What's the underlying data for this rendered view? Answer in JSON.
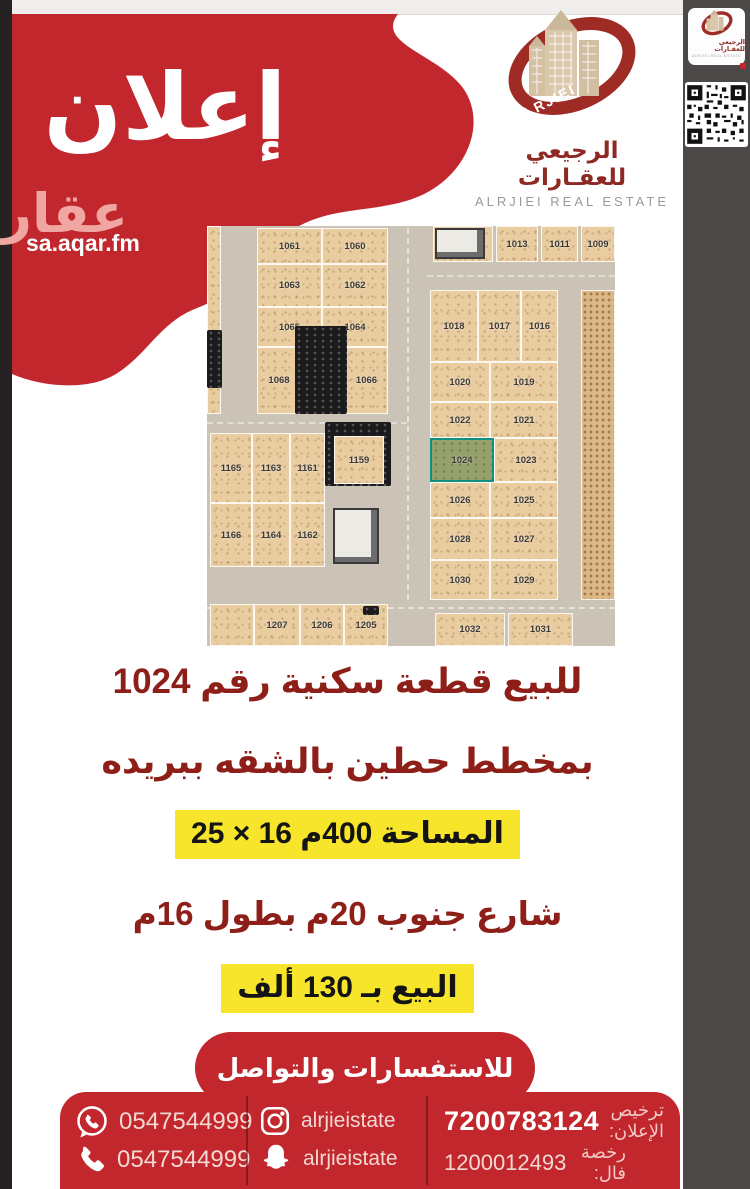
{
  "brand": {
    "announcement": "إعلان",
    "aqar_word": "عقار",
    "aqar_url": "sa.aqar.fm",
    "logo_name_ar": "الرجيعي للعقـارات",
    "logo_name_en": "ALRJIEI REAL ESTATE",
    "logo_ribbon": "ALRJIEI"
  },
  "sidebar": {
    "items": [
      {
        "icon": "location-pin",
        "label": "بريدة - حي الشقة"
      },
      {
        "icon": "land-plot",
        "label": "أرض للبيع"
      },
      {
        "icon": "area-resize",
        "label": "400 م²"
      },
      {
        "icon": "price-money",
        "label": "130 ألف"
      }
    ]
  },
  "details": {
    "line1": "للبيع قطعة سكنية رقم 1024",
    "line2": "بمخطط حطين بالشقه ببريده",
    "line3": "المساحة 400م 16 × 25",
    "line4": "شارع جنوب 20م بطول 16م",
    "line5": "البيع بـ 130 ألف"
  },
  "contact": {
    "heading": "للاستفسارات والتواصل",
    "whatsapp": "0547544999",
    "phone": "0547544999",
    "instagram": "alrjieistate",
    "snapchat": "alrjieistate",
    "ad_license_label": "ترخيص الإعلان:",
    "ad_license": "7200783124",
    "fal_license_label": "رخصة فال:",
    "fal_license": "1200012493"
  },
  "colors": {
    "red": "#c1272d",
    "maroon_text": "#8e1e18",
    "yellow_highlight": "#f6e52b",
    "sidebar_bg": "#4b4847",
    "green_accent": "#55b157",
    "highlight_plot_border": "#0f9080"
  },
  "map": {
    "highlighted_plot": "1024",
    "plots": [
      {
        "label": "",
        "x": 0,
        "y": 0,
        "w": 14,
        "h": 188
      },
      {
        "label": "1061",
        "x": 50,
        "y": 2,
        "w": 65,
        "h": 36
      },
      {
        "label": "1060",
        "x": 115,
        "y": 2,
        "w": 66,
        "h": 36
      },
      {
        "label": "1063",
        "x": 50,
        "y": 38,
        "w": 65,
        "h": 43
      },
      {
        "label": "1062",
        "x": 115,
        "y": 38,
        "w": 66,
        "h": 43
      },
      {
        "label": "1065",
        "x": 50,
        "y": 81,
        "w": 65,
        "h": 40
      },
      {
        "label": "1064",
        "x": 115,
        "y": 81,
        "w": 66,
        "h": 40
      },
      {
        "label": "1068",
        "x": 50,
        "y": 121,
        "w": 44,
        "h": 67
      },
      {
        "label": "",
        "x": 94,
        "y": 121,
        "w": 44,
        "h": 67
      },
      {
        "label": "1066",
        "x": 138,
        "y": 121,
        "w": 43,
        "h": 67
      },
      {
        "label": "1015",
        "x": 226,
        "y": 0,
        "w": 60,
        "h": 36
      },
      {
        "label": "1013",
        "x": 289,
        "y": 0,
        "w": 42,
        "h": 36
      },
      {
        "label": "1011",
        "x": 334,
        "y": 0,
        "w": 37,
        "h": 36
      },
      {
        "label": "1009",
        "x": 374,
        "y": 0,
        "w": 34,
        "h": 36
      },
      {
        "label": "1018",
        "x": 223,
        "y": 64,
        "w": 48,
        "h": 72
      },
      {
        "label": "1017",
        "x": 271,
        "y": 64,
        "w": 43,
        "h": 72
      },
      {
        "label": "1016",
        "x": 314,
        "y": 64,
        "w": 37,
        "h": 72
      },
      {
        "label": "1020",
        "x": 223,
        "y": 136,
        "w": 60,
        "h": 40
      },
      {
        "label": "1019",
        "x": 283,
        "y": 136,
        "w": 68,
        "h": 40
      },
      {
        "label": "1022",
        "x": 223,
        "y": 176,
        "w": 60,
        "h": 36
      },
      {
        "label": "1021",
        "x": 283,
        "y": 176,
        "w": 68,
        "h": 36
      },
      {
        "label": "1024",
        "x": 223,
        "y": 212,
        "w": 64,
        "h": 44,
        "highlight": true
      },
      {
        "label": "1023",
        "x": 287,
        "y": 212,
        "w": 64,
        "h": 44
      },
      {
        "label": "1026",
        "x": 223,
        "y": 256,
        "w": 60,
        "h": 36
      },
      {
        "label": "1025",
        "x": 283,
        "y": 256,
        "w": 68,
        "h": 36
      },
      {
        "label": "1028",
        "x": 223,
        "y": 292,
        "w": 60,
        "h": 42
      },
      {
        "label": "1027",
        "x": 283,
        "y": 292,
        "w": 68,
        "h": 42
      },
      {
        "label": "1030",
        "x": 223,
        "y": 334,
        "w": 60,
        "h": 40
      },
      {
        "label": "1029",
        "x": 283,
        "y": 334,
        "w": 68,
        "h": 40
      },
      {
        "label": "",
        "x": 374,
        "y": 64,
        "w": 34,
        "h": 310,
        "shade": true
      },
      {
        "label": "1032",
        "x": 228,
        "y": 387,
        "w": 70,
        "h": 33
      },
      {
        "label": "1031",
        "x": 301,
        "y": 387,
        "w": 65,
        "h": 33
      },
      {
        "label": "1165",
        "x": 3,
        "y": 207,
        "w": 42,
        "h": 70
      },
      {
        "label": "1163",
        "x": 45,
        "y": 207,
        "w": 38,
        "h": 70
      },
      {
        "label": "1161",
        "x": 83,
        "y": 207,
        "w": 35,
        "h": 70
      },
      {
        "label": "1159",
        "x": 127,
        "y": 210,
        "w": 50,
        "h": 48
      },
      {
        "label": "1166",
        "x": 3,
        "y": 277,
        "w": 42,
        "h": 64
      },
      {
        "label": "1164",
        "x": 45,
        "y": 277,
        "w": 38,
        "h": 64
      },
      {
        "label": "1162",
        "x": 83,
        "y": 277,
        "w": 35,
        "h": 64
      },
      {
        "label": "",
        "x": 3,
        "y": 378,
        "w": 44,
        "h": 42
      },
      {
        "label": "1207",
        "x": 47,
        "y": 378,
        "w": 46,
        "h": 42
      },
      {
        "label": "1206",
        "x": 93,
        "y": 378,
        "w": 44,
        "h": 42
      },
      {
        "label": "1205",
        "x": 137,
        "y": 378,
        "w": 44,
        "h": 42
      }
    ],
    "buildings": [
      {
        "layer": "under",
        "type": "dark",
        "x": 118,
        "y": 196,
        "w": 66,
        "h": 64
      },
      {
        "layer": "over",
        "type": "dark",
        "x": 88,
        "y": 100,
        "w": 52,
        "h": 88
      },
      {
        "layer": "over",
        "type": "light",
        "x": 126,
        "y": 282,
        "w": 46,
        "h": 56
      },
      {
        "layer": "over",
        "type": "light",
        "x": 228,
        "y": 2,
        "w": 50,
        "h": 31
      },
      {
        "layer": "over",
        "type": "dark",
        "x": 0,
        "y": 104,
        "w": 15,
        "h": 58
      },
      {
        "layer": "over",
        "type": "dark",
        "x": 156,
        "y": 380,
        "w": 16,
        "h": 9
      }
    ]
  }
}
